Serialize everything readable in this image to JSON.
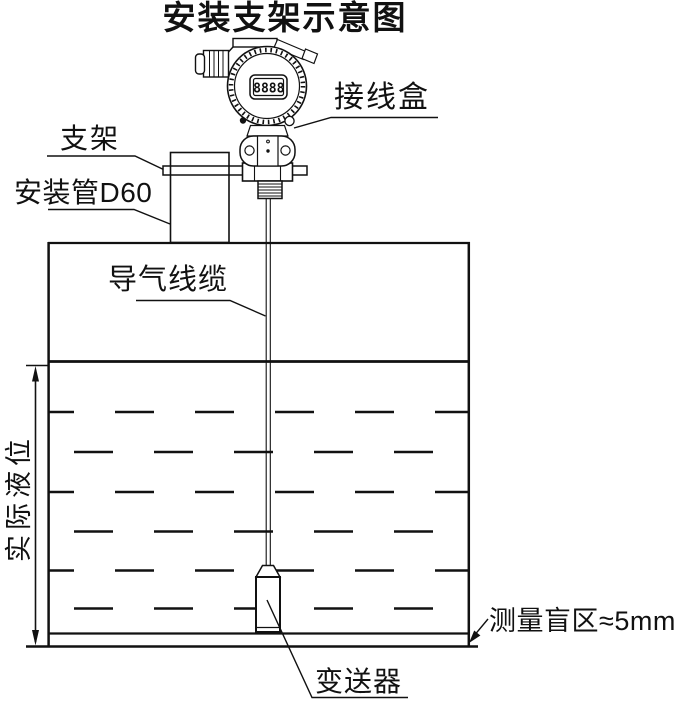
{
  "title": "安装支架示意图",
  "labels": {
    "junction_box": "接线盒",
    "bracket": "支架",
    "mounting_pipe": "安装管D60",
    "air_cable": "导气线缆",
    "actual_level": "实际液位",
    "blind_zone": "测量盲区≈5mm",
    "transmitter_probe": "变送器"
  },
  "device": {
    "lcd_reading": "8888"
  },
  "colors": {
    "line": "#111111",
    "background": "#ffffff"
  }
}
